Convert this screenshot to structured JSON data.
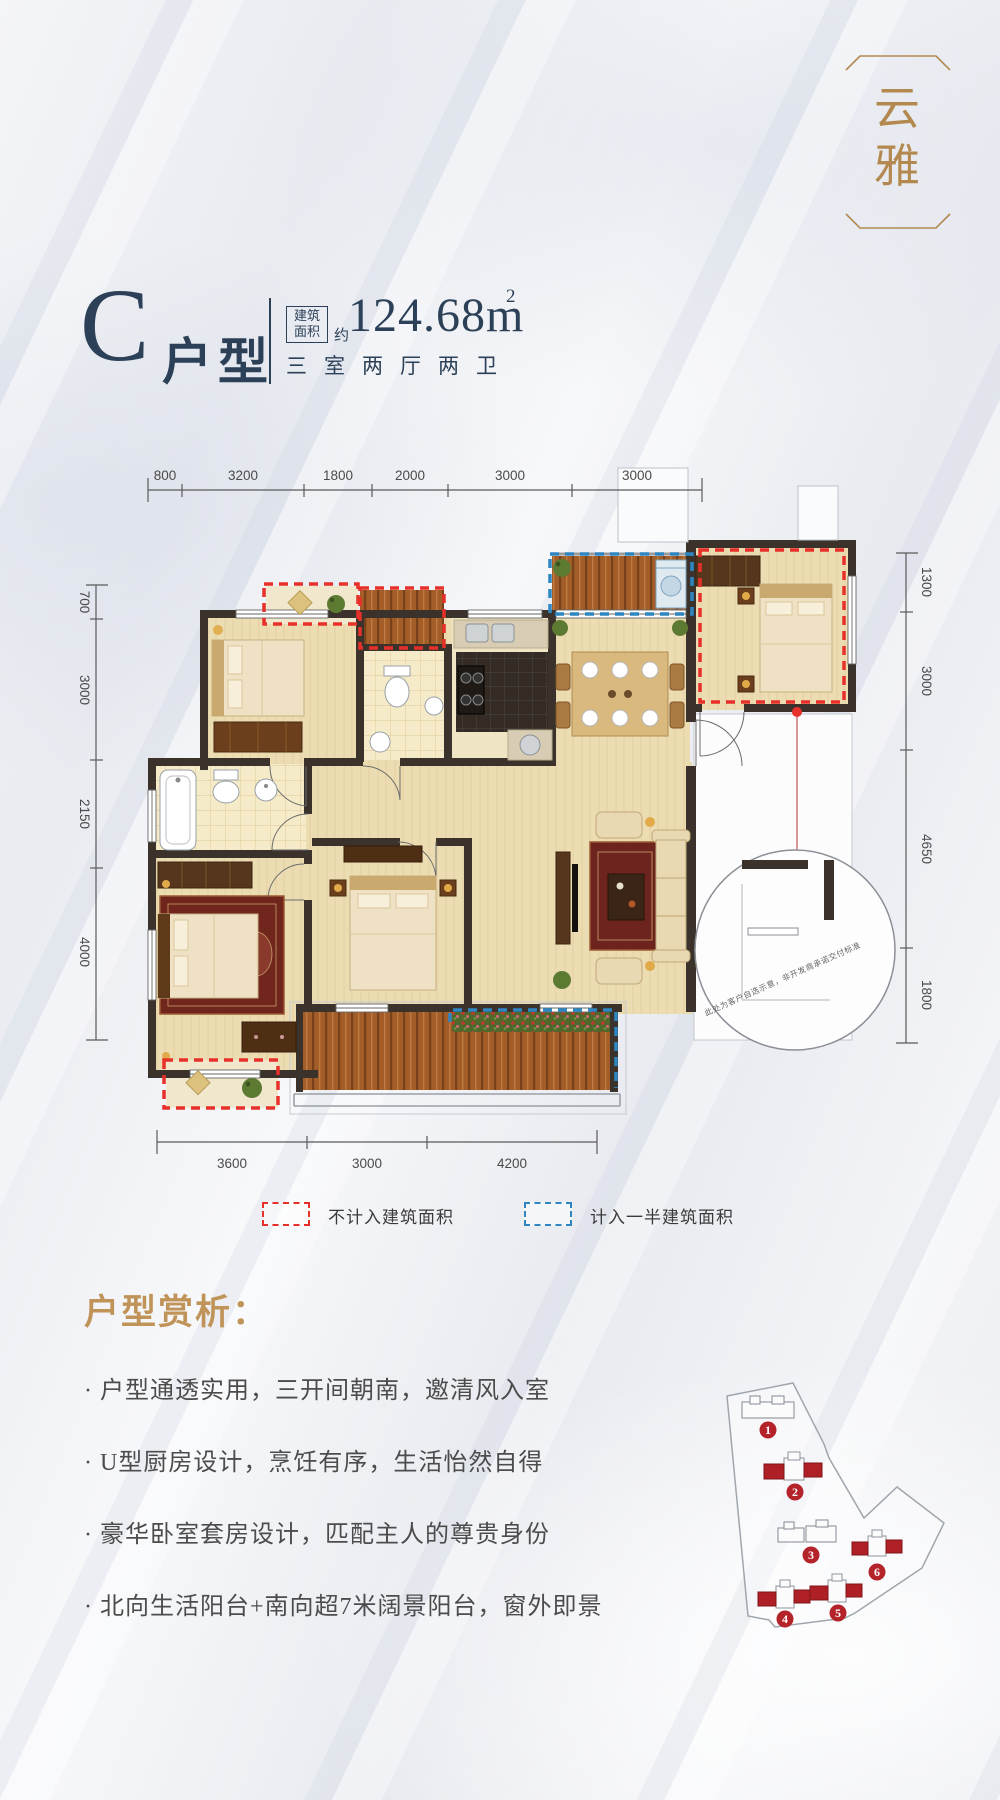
{
  "logo": {
    "chars": [
      "云",
      "雅"
    ]
  },
  "header": {
    "type_letter": "C",
    "type_suffix": "户型",
    "area_box_line1": "建筑",
    "area_box_line2": "面积",
    "approx": "约",
    "area_value": "124.68m",
    "area_sup": "2",
    "layout_desc": "三室两厅两卫"
  },
  "plan": {
    "dims_top": [
      "800",
      "3200",
      "1800",
      "2000",
      "3000",
      "3000"
    ],
    "dims_left": [
      "700",
      "3000",
      "2150",
      "4000"
    ],
    "dims_right": [
      "1300",
      "3000",
      "4650",
      "1800"
    ],
    "dims_bottom": [
      "3600",
      "3000",
      "4200"
    ],
    "note": "此处为客户自选示意，非开发商承诺交付标准"
  },
  "legend": {
    "red_label": "不计入建筑面积",
    "blue_label": "计入一半建筑面积",
    "red_color": "#e8302a",
    "blue_color": "#2e86c1"
  },
  "analysis": {
    "title": "户型赏析：",
    "bullets": [
      "· 户型通透实用，三开间朝南，邀清风入室",
      "· U型厨房设计，烹饪有序，生活怡然自得",
      "· 豪华卧室套房设计，匹配主人的尊贵身份",
      "· 北向生活阳台+南向超7米阔景阳台，窗外即景"
    ]
  },
  "siteplan": {
    "markers": [
      "1",
      "2",
      "3",
      "4",
      "5",
      "6"
    ]
  }
}
